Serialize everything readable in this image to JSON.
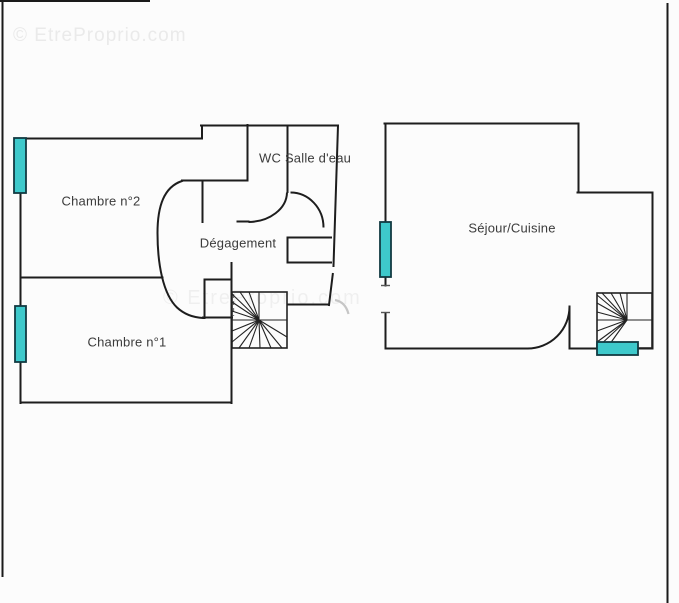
{
  "watermark": {
    "text": "© EtreProprio.com"
  },
  "plan": {
    "rooms": {
      "chambre2": "Chambre n°2",
      "chambre1": "Chambre n°1",
      "degagement": "Dégagement",
      "wc": "WC",
      "salle_deau": "Salle d'eau",
      "sejour_cuisine": "Séjour/Cuisine"
    },
    "symbols": {
      "staircase": "spiral-staircase-symbol",
      "window": "window-symbol",
      "door": "door-swing-arc"
    },
    "colors": {
      "wall": "#1d1d1d",
      "window_fill": "#3ec9cb",
      "window_stroke": "#123a42",
      "background": "#fcfcfc",
      "watermark": "#eaeaea"
    }
  }
}
